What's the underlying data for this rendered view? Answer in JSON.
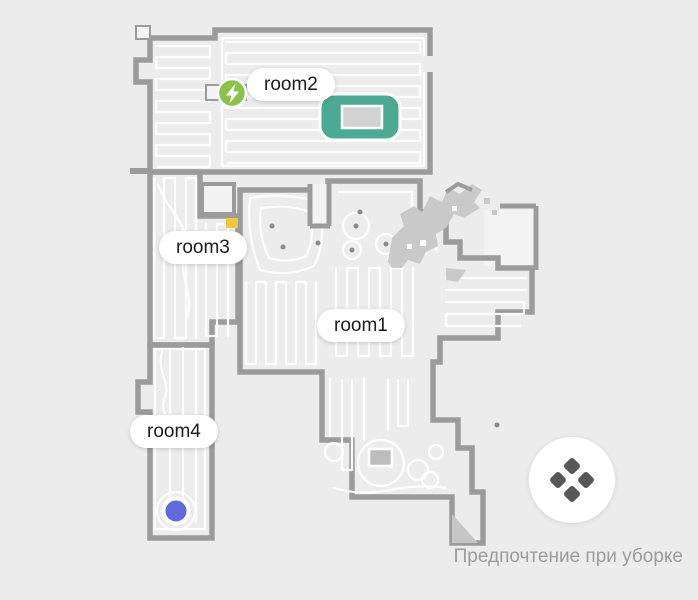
{
  "app": {
    "screen": "robot-vacuum-room-map"
  },
  "map": {
    "rooms": [
      {
        "name": "room1",
        "label": "room1",
        "color": "#F5C63C"
      },
      {
        "name": "room2",
        "label": "room2",
        "color": "#4BAB92"
      },
      {
        "name": "room3",
        "label": "room3",
        "color": "#2E90F2"
      },
      {
        "name": "room4",
        "label": "room4",
        "color": "#EF6F79"
      }
    ],
    "wall_color": "#9B9B9B",
    "background_color": "#ECECEC",
    "unexplored_color": "#C9C9C9",
    "clean_path_color": "#FFFFFF",
    "dock": {
      "icon": "charging-dock-icon",
      "color": "#8BC34A"
    },
    "robot": {
      "icon": "robot-position-marker",
      "color": "#5F6BDB"
    }
  },
  "footer": {
    "preference_button": {
      "icon": "cleaning-preference-icon",
      "icon_color": "#58585A"
    },
    "caption": "Предпочтение при уборке"
  }
}
